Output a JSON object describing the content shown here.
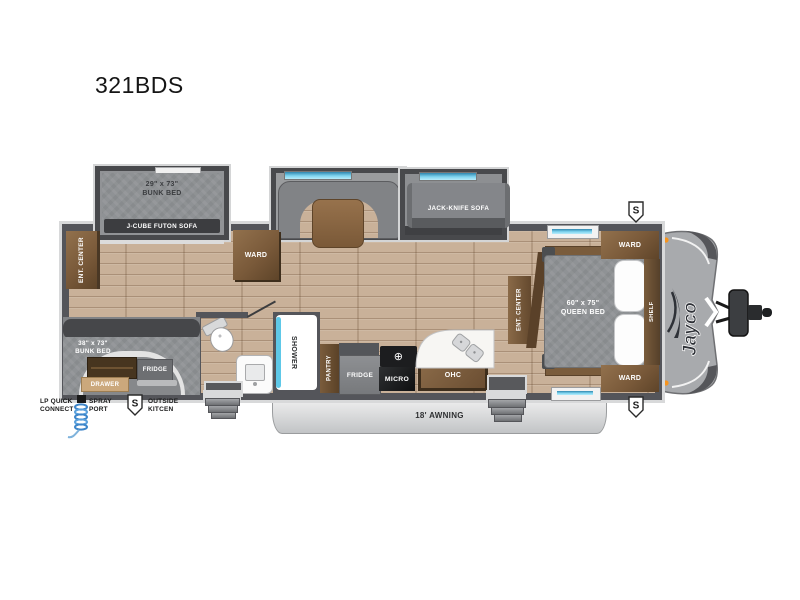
{
  "title": "321BDS",
  "brand": "Jayco",
  "speakers": {
    "symbol": "S"
  },
  "awning": {
    "label": "18' AWNING"
  },
  "icons": {
    "burner": "⊕"
  },
  "slides": {
    "bunk": {
      "size": "29\" x 73\"",
      "name": "BUNK BED",
      "futon": "J-CUBE FUTON SOFA"
    },
    "jackknife": {
      "name": "JACK-KNIFE SOFA"
    }
  },
  "rear": {
    "ent_center": "ENT. CENTER",
    "bunk_size": "38\" x 73\"",
    "bunk_name": "BUNK BED",
    "outside_fridge": "FRIDGE",
    "drawer": "DRAWER"
  },
  "mid": {
    "ward": "WARD",
    "shower": "SHOWER",
    "pantry": "PANTRY",
    "fridge": "FRIDGE",
    "micro": "MICRO",
    "ohc": "OHC"
  },
  "bedroom": {
    "ent_center": "ENT. CENTER",
    "bed_size": "60\" x 75\"",
    "bed_name": "QUEEN BED",
    "ward_top": "WARD",
    "ward_bottom": "WARD",
    "shelf": "SHELF"
  },
  "exterior": {
    "lp_line1": "LP QUICK",
    "lp_line2": "CONNECT",
    "spray_line1": "SPRAY",
    "spray_line2": "PORT",
    "outside_line1": "OUTSIDE",
    "outside_line2": "KITCEN"
  },
  "colors": {
    "wall": "#54555a",
    "wood_floor": "#c9b199",
    "cabinet_brown": "#7a5a3a",
    "window_blue": "#3d9dc4",
    "marker_orange": "#f7941d"
  }
}
